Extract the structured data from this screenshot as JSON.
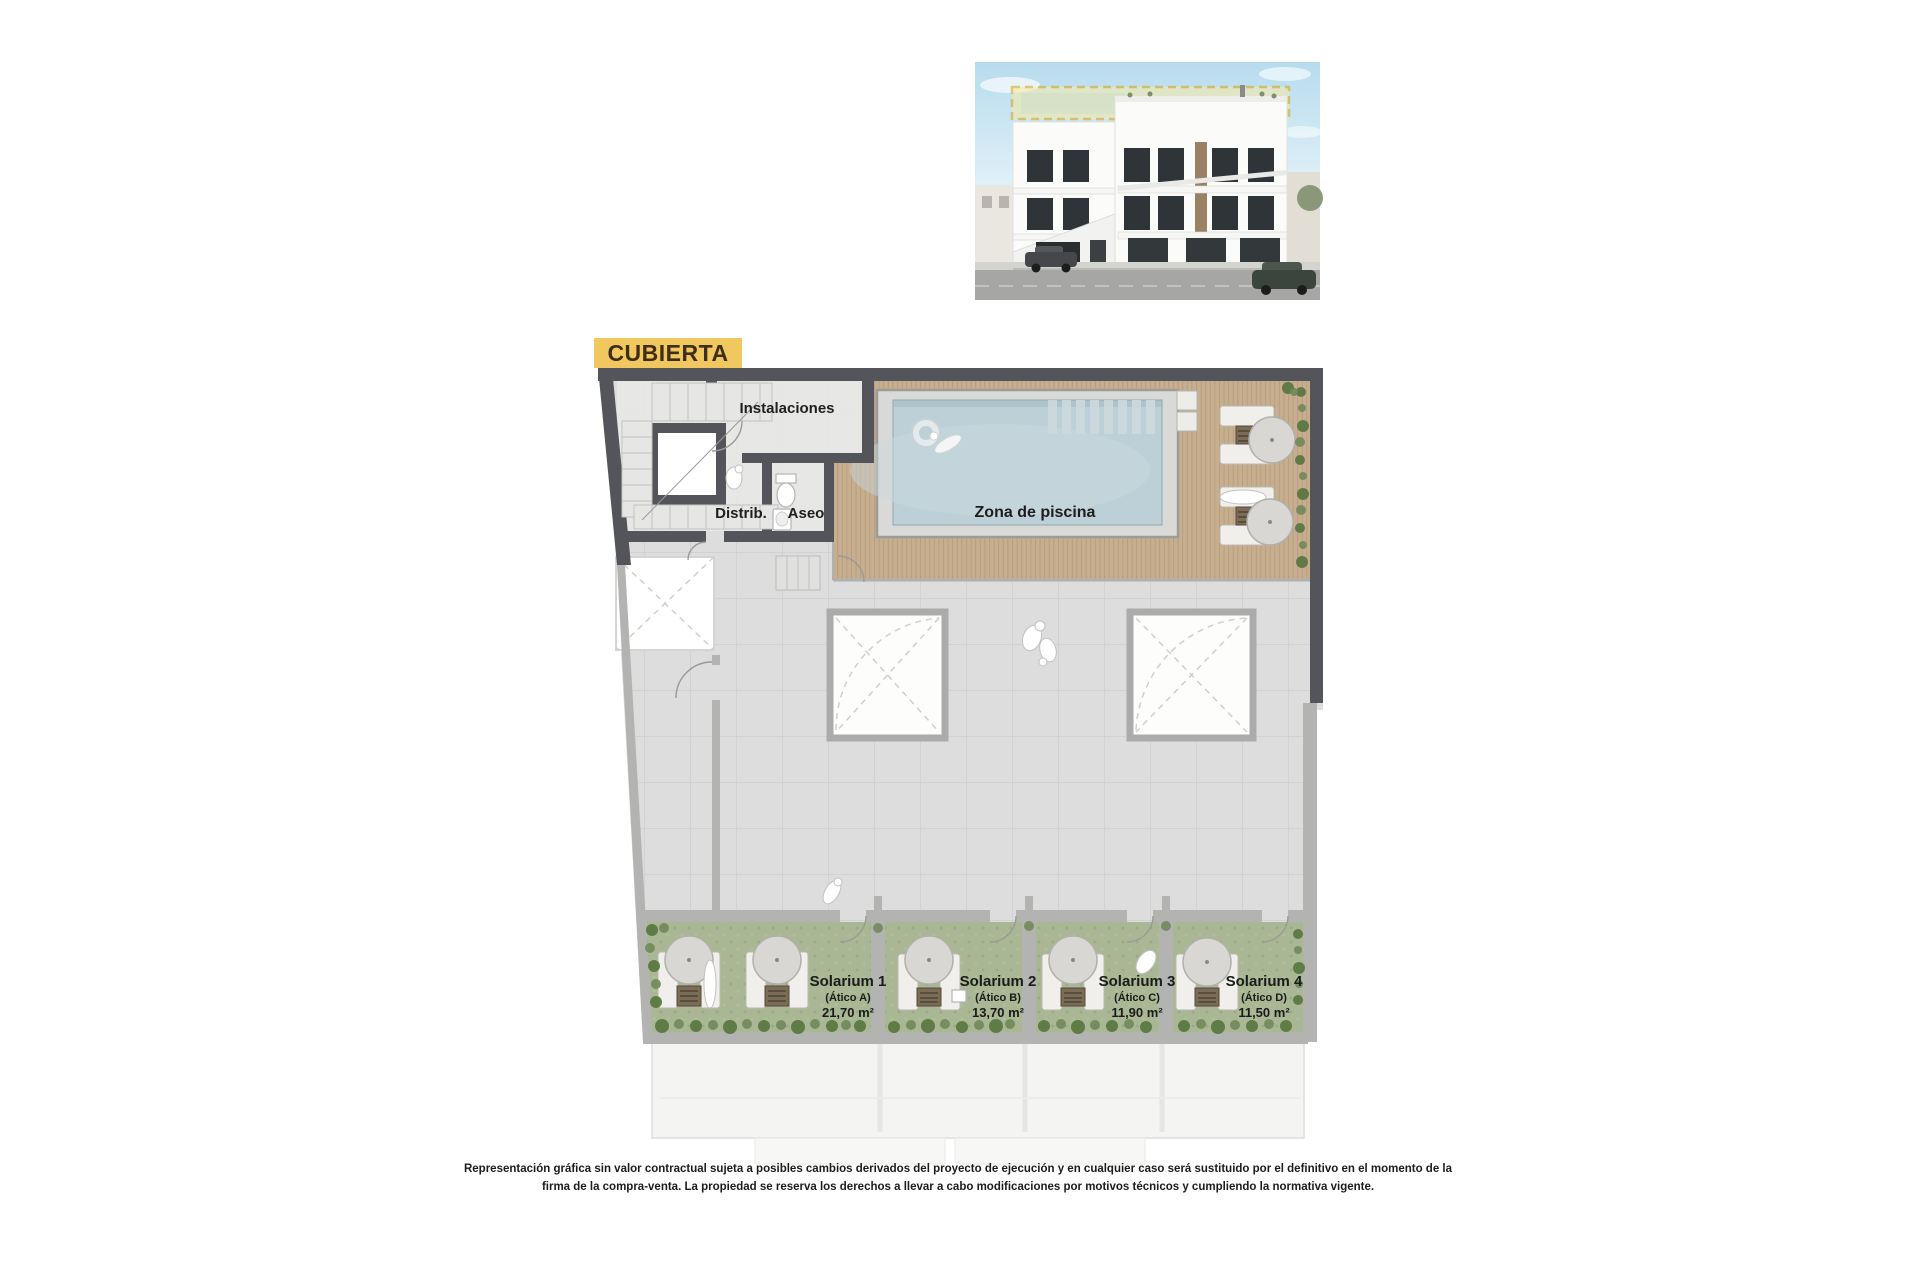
{
  "sheet": {
    "background": "#ffffff"
  },
  "render": {
    "description": "building-facade-render",
    "sky_top": "#b7dcee",
    "sky_bottom": "#e8f4fa",
    "facade": "#fbfbfa",
    "window": "#2f3438",
    "highlight_fill": "#f6e9a6",
    "highlight_stroke": "#d9a81c",
    "street": "#a6a6a5",
    "sidewalk": "#d3d3d0",
    "wood_accent": "#9b8164",
    "car_left": "#45474a",
    "car_right": "#3a453e"
  },
  "plan": {
    "title": "CUBIERTA",
    "labels": {
      "instalaciones": "Instalaciones",
      "distrib": "Distrib.",
      "aseo": "Aseo",
      "pool": "Zona de piscina"
    },
    "solariums": [
      {
        "name": "Solarium 1",
        "unit": "(Ático A)",
        "area": "21,70 m²"
      },
      {
        "name": "Solarium 2",
        "unit": "(Ático B)",
        "area": "13,70 m²"
      },
      {
        "name": "Solarium 3",
        "unit": "(Ático C)",
        "area": "11,90 m²"
      },
      {
        "name": "Solarium 4",
        "unit": "(Ático D)",
        "area": "11,50 m²"
      }
    ],
    "colors": {
      "wall_dark": "#54555A",
      "wall_light": "#B3B3B1",
      "tile": "#DCDDDC",
      "tile_line": "#CBCCCB",
      "deck": "#C6AE8F",
      "deck_line": "#AB9172",
      "water": "#BDD0D7",
      "pool_coping": "#D9D9D7",
      "grass": "#A9B795",
      "plant_dark": "#5C7842",
      "plant_light": "#71895A",
      "title_bg": "#F1C75F",
      "title_text": "#3F2E18"
    }
  },
  "disclaimer": {
    "line1": "Representación gráfica sin valor contractual sujeta a posibles cambios derivados del proyecto de ejecución y en cualquier caso será sustituido por el definitivo en el momento de la",
    "line2": "firma de la compra-venta. La propiedad se reserva los derechos a llevar a cabo modificaciones por motivos técnicos y cumpliendo la normativa vigente."
  }
}
